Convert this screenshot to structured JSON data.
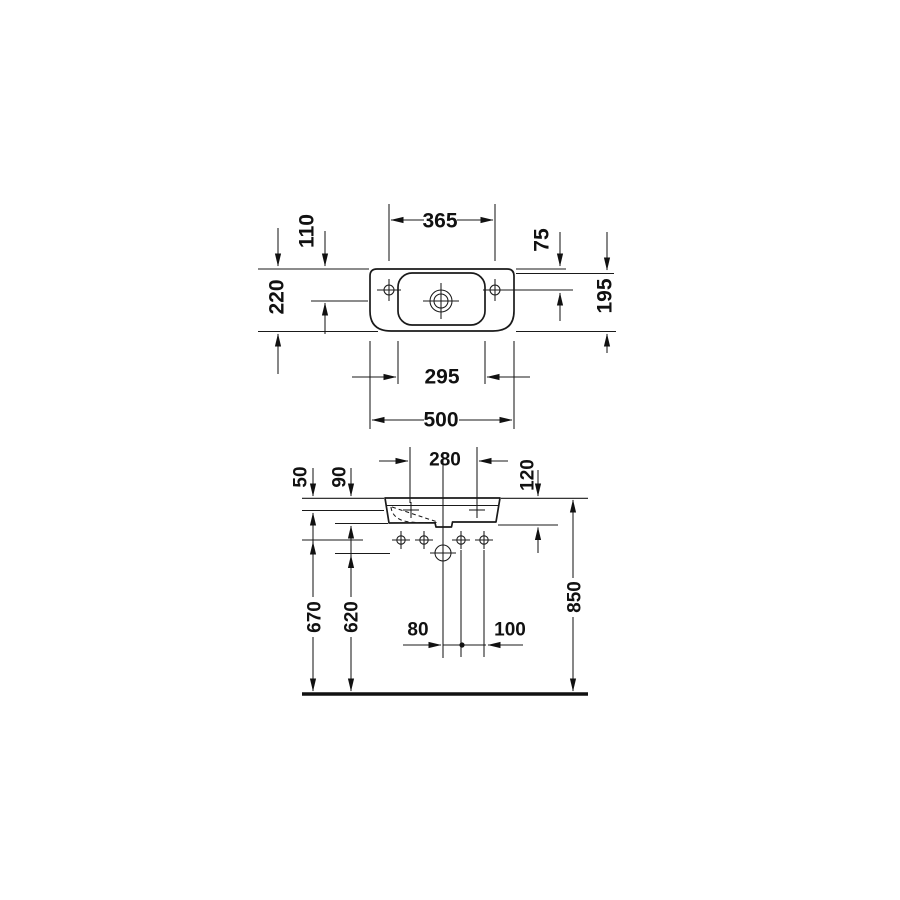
{
  "colors": {
    "line": "#1a1a1a",
    "background": "#ffffff"
  },
  "plan_view": {
    "dims": {
      "faucet_hole_spacing": "365",
      "center_hole_from_back": "110",
      "overall_depth": "220",
      "side_hole_from_back": "75",
      "bowl_to_front_edge": "195",
      "inner_bowl_width": "295",
      "overall_width": "500"
    }
  },
  "front_view": {
    "dims": {
      "fixing_hole_spacing": "280",
      "fixing_holes_from_rim": "50",
      "body_height_back": "90",
      "body_height_front": "120",
      "bracket_holes_above_floor": "670",
      "drain_above_floor": "620",
      "drain_to_bracket_hole": "80",
      "bracket_hole_spacing": "100",
      "rim_above_floor": "850"
    }
  }
}
